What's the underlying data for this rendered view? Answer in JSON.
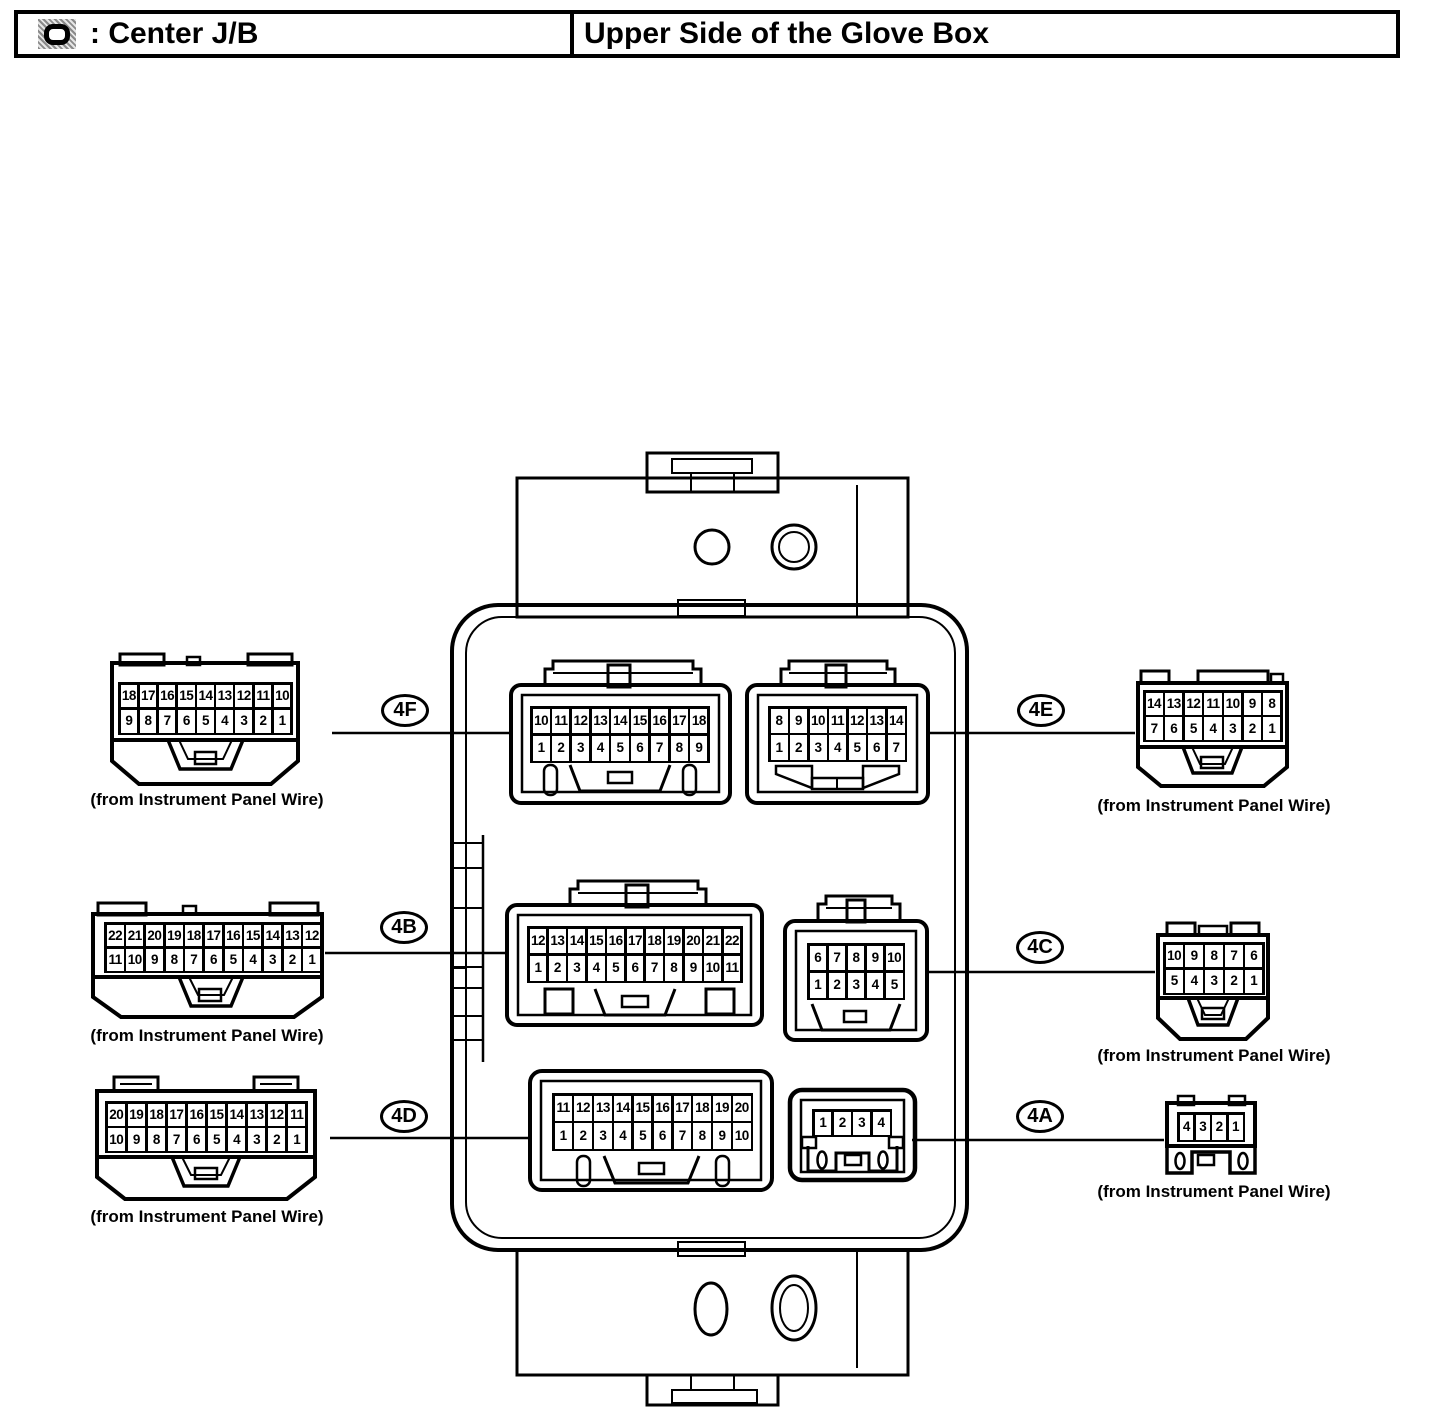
{
  "header": {
    "icon": "junction-block-symbol-icon",
    "left_label": ": Center J/B",
    "right_label": "Upper Side of the Glove Box"
  },
  "caption_text": "(from Instrument Panel Wire)",
  "callouts": {
    "c4f": "4F",
    "c4b": "4B",
    "c4d": "4D",
    "c4e": "4E",
    "c4c": "4C",
    "c4a": "4A"
  },
  "pin_grids": {
    "ext_left_18": [
      [
        "18",
        "17",
        "16",
        "15",
        "14",
        "13",
        "12",
        "11",
        "10"
      ],
      [
        "9",
        "8",
        "7",
        "6",
        "5",
        "4",
        "3",
        "2",
        "1"
      ]
    ],
    "ext_left_22": [
      [
        "22",
        "21",
        "20",
        "19",
        "18",
        "17",
        "16",
        "15",
        "14",
        "13",
        "12"
      ],
      [
        "11",
        "10",
        "9",
        "8",
        "7",
        "6",
        "5",
        "4",
        "3",
        "2",
        "1"
      ]
    ],
    "ext_left_20": [
      [
        "20",
        "19",
        "18",
        "17",
        "16",
        "15",
        "14",
        "13",
        "12",
        "11"
      ],
      [
        "10",
        "9",
        "8",
        "7",
        "6",
        "5",
        "4",
        "3",
        "2",
        "1"
      ]
    ],
    "ext_right_14": [
      [
        "14",
        "13",
        "12",
        "11",
        "10",
        "9",
        "8"
      ],
      [
        "7",
        "6",
        "5",
        "4",
        "3",
        "2",
        "1"
      ]
    ],
    "ext_right_10": [
      [
        "10",
        "9",
        "8",
        "7",
        "6"
      ],
      [
        "5",
        "4",
        "3",
        "2",
        "1"
      ]
    ],
    "ext_right_4": [
      [
        "4",
        "3",
        "2",
        "1"
      ]
    ],
    "c4f": [
      [
        "10",
        "11",
        "12",
        "13",
        "14",
        "15",
        "16",
        "17",
        "18"
      ],
      [
        "1",
        "2",
        "3",
        "4",
        "5",
        "6",
        "7",
        "8",
        "9"
      ]
    ],
    "c4e": [
      [
        "8",
        "9",
        "10",
        "11",
        "12",
        "13",
        "14"
      ],
      [
        "1",
        "2",
        "3",
        "4",
        "5",
        "6",
        "7"
      ]
    ],
    "c4b": [
      [
        "12",
        "13",
        "14",
        "15",
        "16",
        "17",
        "18",
        "19",
        "20",
        "21",
        "22"
      ],
      [
        "1",
        "2",
        "3",
        "4",
        "5",
        "6",
        "7",
        "8",
        "9",
        "10",
        "11"
      ]
    ],
    "c4c": [
      [
        "6",
        "7",
        "8",
        "9",
        "10"
      ],
      [
        "1",
        "2",
        "3",
        "4",
        "5"
      ]
    ],
    "c4d": [
      [
        "11",
        "12",
        "13",
        "14",
        "15",
        "16",
        "17",
        "18",
        "19",
        "20"
      ],
      [
        "1",
        "2",
        "3",
        "4",
        "5",
        "6",
        "7",
        "8",
        "9",
        "10"
      ]
    ],
    "c4a": [
      [
        "1",
        "2",
        "3",
        "4"
      ]
    ]
  }
}
